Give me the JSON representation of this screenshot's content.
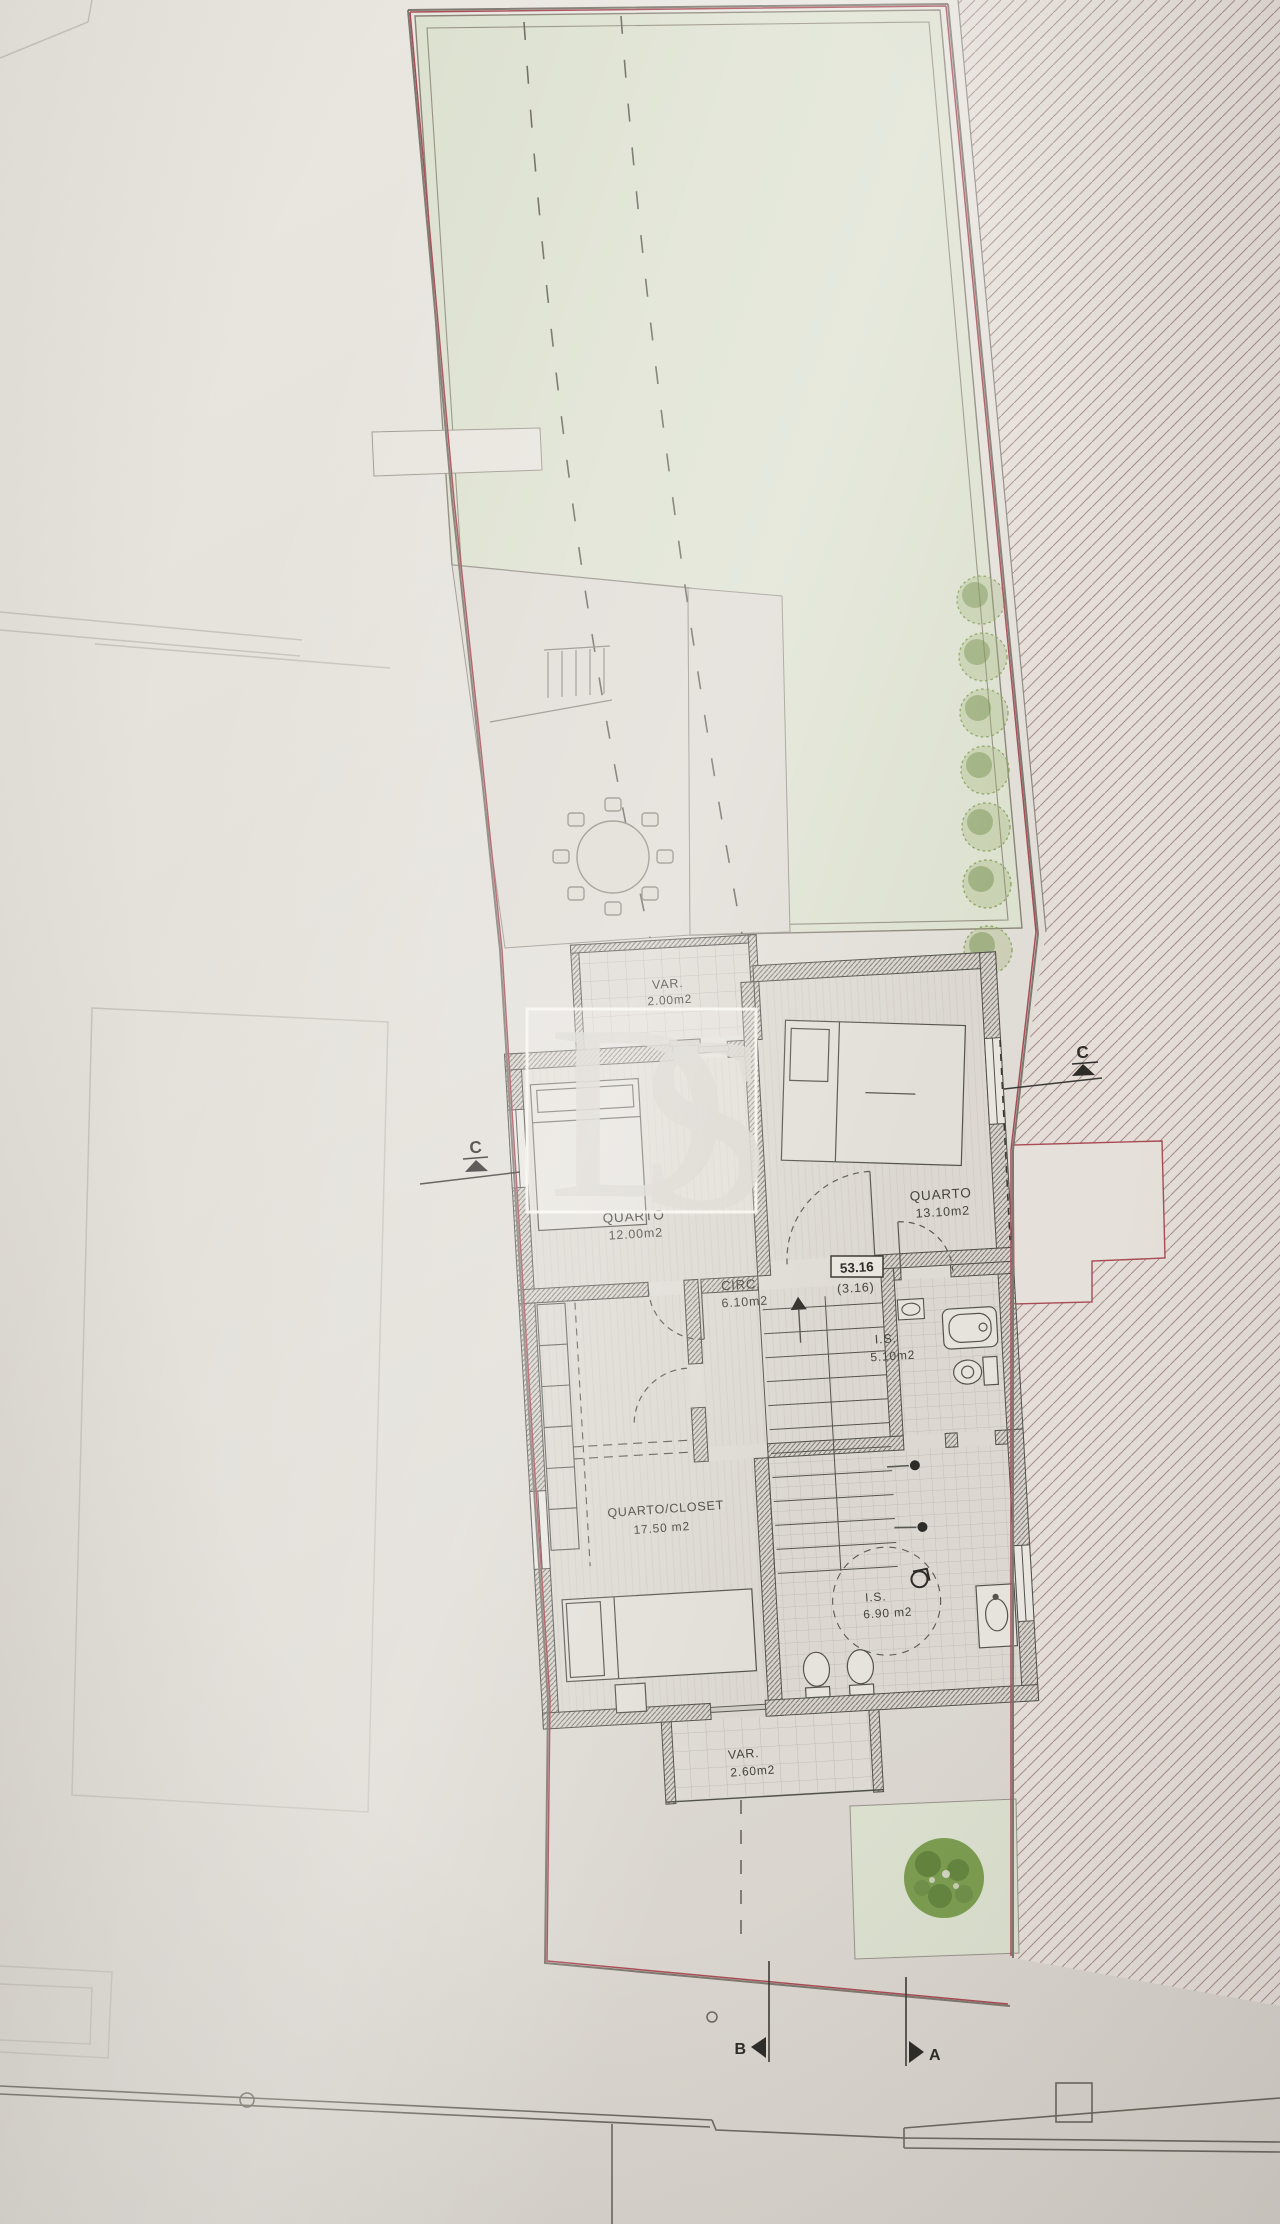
{
  "watermark": {
    "text_d": "D",
    "text_s": "S"
  },
  "rooms": {
    "var_top": {
      "name": "VAR.",
      "area": "2.00m2"
    },
    "quarto_left": {
      "name": "QUARTO",
      "area": "12.00m2"
    },
    "quarto_right": {
      "name": "QUARTO",
      "area": "13.10m2"
    },
    "circ": {
      "name": "CIRC.",
      "area": "6.10m2"
    },
    "is_upper": {
      "name": "I.S.",
      "area": "5.10m2"
    },
    "quarto_closet": {
      "name": "QUARTO/CLOSET",
      "area": "17.50 m2"
    },
    "is_lower": {
      "name": "I.S.",
      "area": "6.90 m2"
    },
    "var_bottom": {
      "name": "VAR.",
      "area": "2.60m2"
    }
  },
  "annotations": {
    "level": "53.16",
    "level_sub": "(3.16)"
  },
  "section_markers": {
    "right_c": "C",
    "left_c": "C",
    "bottom_left": "B",
    "bottom_right": "A"
  },
  "colors": {
    "paper": "#e5e2db",
    "yard_green": "#dde1d0",
    "tree_green": "#6f9146",
    "boundary_red": "#a84b55",
    "line_dark": "#52504b"
  }
}
